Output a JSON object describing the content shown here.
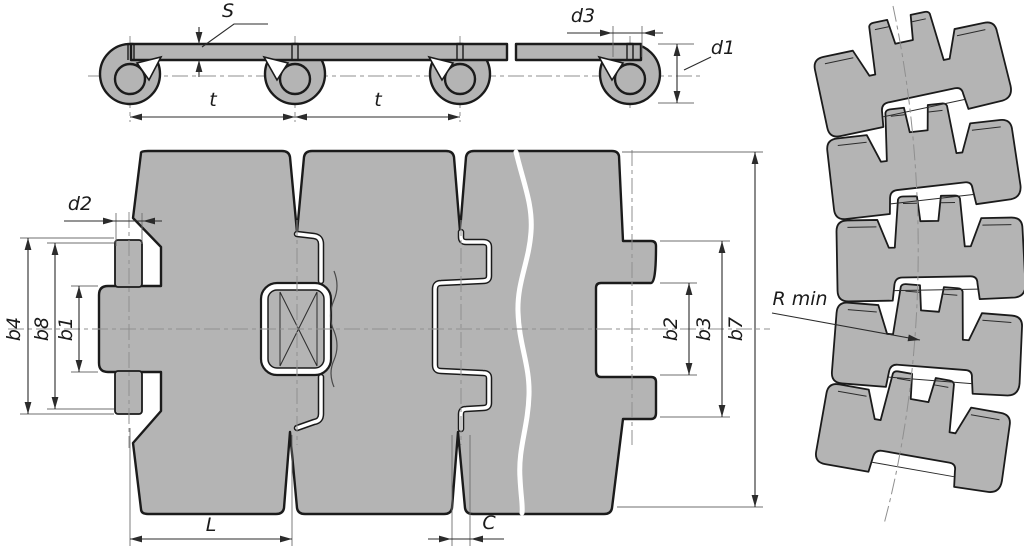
{
  "colors": {
    "part_fill": "#b4b4b4",
    "outline": "#1b1b1b",
    "dimension_line": "#2b2b2b",
    "centerline": "#8f8f8f",
    "background": "#ffffff"
  },
  "views": {
    "side": {
      "labels": {
        "plate_thickness": "S",
        "pitch_left": "t",
        "pitch_right": "t",
        "hinge_bore": "d3",
        "hinge_outer": "d1"
      }
    },
    "plan": {
      "labels": {
        "pin_diameter": "d2",
        "width_b4": "b4",
        "width_b8": "b8",
        "width_b1": "b1",
        "width_b2": "b2",
        "width_b3": "b3",
        "plate_width_b7": "b7",
        "plate_length": "L",
        "clearance": "C"
      }
    },
    "curved": {
      "labels": {
        "min_radius": "R min"
      }
    }
  }
}
